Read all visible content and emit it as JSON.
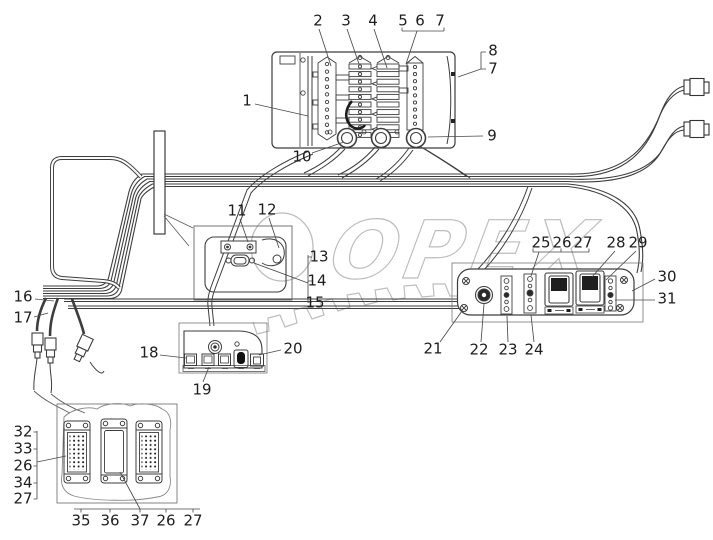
{
  "watermark": {
    "text": "OPEX",
    "color": "#bdbdbd"
  },
  "colors": {
    "line": "#3d3d3d",
    "thin": "#5a5a5a",
    "label": "#1d1d1d",
    "background": "#ffffff"
  },
  "callouts": {
    "c1": "1",
    "c2": "2",
    "c3": "3",
    "c4": "4",
    "c5": "5",
    "c6": "6",
    "c7": "7",
    "c8": "8",
    "c7b": "7",
    "c9": "9",
    "c10": "10",
    "c11": "11",
    "c12": "12",
    "c13": "13",
    "c14": "14",
    "c15": "15",
    "c16": "16",
    "c17": "17",
    "c18": "18",
    "c19": "19",
    "c20": "20",
    "c21": "21",
    "c22": "22",
    "c23": "23",
    "c24": "24",
    "c25": "25",
    "c26a": "26",
    "c27a": "27",
    "c28": "28",
    "c29": "29",
    "c30": "30",
    "c31": "31",
    "c32": "32",
    "c33": "33",
    "c26b": "26",
    "c34": "34",
    "c27b": "27",
    "c35": "35",
    "c36": "36",
    "c37": "37",
    "c26c": "26",
    "c27c": "27"
  }
}
